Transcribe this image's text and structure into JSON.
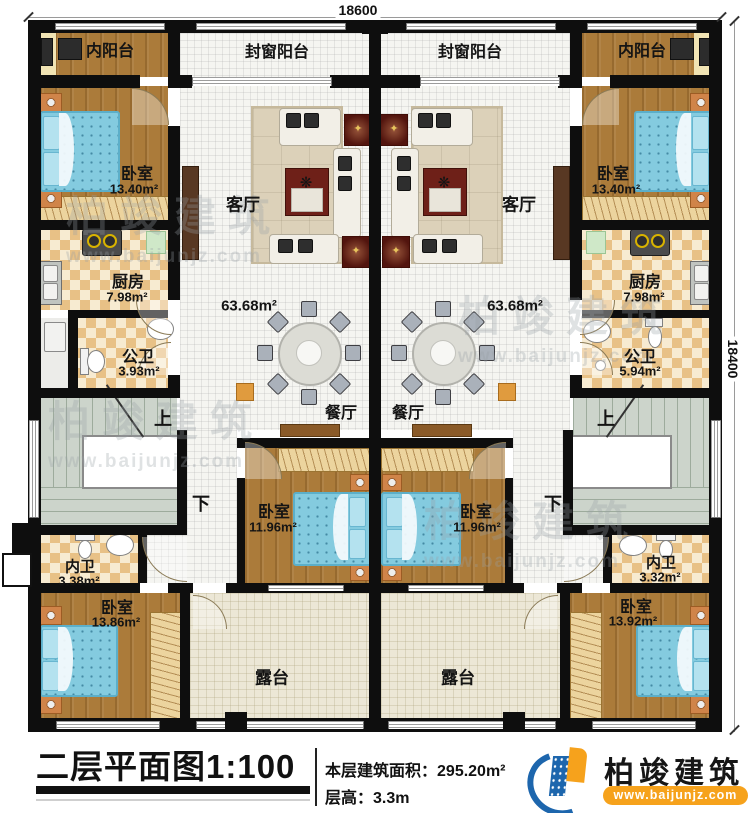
{
  "dimensions": {
    "top": "18600",
    "right": "18400"
  },
  "rooms": {
    "inner_balcony": "内阳台",
    "sealed_balcony": "封窗阳台",
    "bedroom": "卧室",
    "living_room": "客厅",
    "kitchen": "厨房",
    "public_bath": "公卫",
    "dining_room": "餐厅",
    "inner_bath": "内卫",
    "terrace": "露台"
  },
  "areas": {
    "living": "63.68m²",
    "bedroom_top": "13.40m²",
    "kitchen": "7.98m²",
    "public_bath_left": "3.93m²",
    "public_bath_right": "5.94m²",
    "bedroom_mid": "11.96m²",
    "inner_bath_left": "3.38m²",
    "inner_bath_right": "3.32m²",
    "bedroom_bottom_left": "13.86m²",
    "bedroom_bottom_right": "13.92m²"
  },
  "stairs": {
    "up": "上",
    "down": "下"
  },
  "title": {
    "name": "二层平面图",
    "scale": "1:100",
    "floor_area_label": "本层建筑面积：",
    "floor_area_value": "295.20m²",
    "floor_height_label": "层高：",
    "floor_height_value": "3.3m"
  },
  "brand": {
    "name": "柏竣建筑",
    "website": "www.baijunjz.com"
  },
  "watermark": {
    "text": "柏竣建筑",
    "website": "www.baijunjz.com"
  }
}
